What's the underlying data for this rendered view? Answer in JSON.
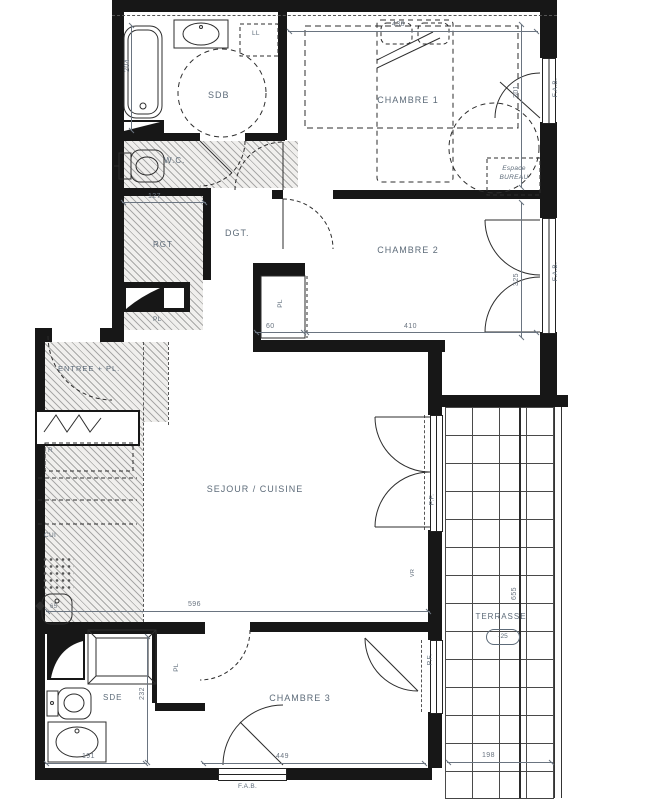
{
  "plan": {
    "rooms": {
      "sdb": "SDB",
      "chambre1": "CHAMBRE 1",
      "wc": "W.C.",
      "dgt": "DGT.",
      "chambre2": "CHAMBRE 2",
      "rgt": "RGT",
      "entree": "ENTREE + PL.",
      "sejour": "SEJOUR / CUISINE",
      "chambre3": "CHAMBRE 3",
      "sde": "SDE",
      "terrasse": "TERRASSE",
      "espace_bureau_1": "Espace",
      "espace_bureau_2": "BUREAU"
    },
    "closets": {
      "pl_couloir": "PL",
      "pl_chambre2": "PL",
      "pl_chambre3": "PL"
    },
    "appliances": {
      "lave_linge": "LL",
      "refrigerateur": "R",
      "cuisine": "CUI"
    },
    "windows": {
      "fab_chambre1": "F.A.B.",
      "fab_chambre2": "F.A.B.",
      "fab_chambre3": "F.A.B.",
      "pf_sejour": "P.F.",
      "pf_chambre3": "P.F.",
      "volet": "VR"
    },
    "levels": {
      "terrasse_level": "-25"
    },
    "dimensions": {
      "baignoire": "204",
      "chambre1_largeur": "438",
      "chambre1_hauteur": "301",
      "wc_largeur": "127",
      "placard_largeur": "60",
      "chambre2_largeur": "410",
      "chambre2_hauteur": "325",
      "sejour_largeur": "596",
      "evier": "65",
      "sde_largeur": "191",
      "sde_hauteur": "232",
      "chambre3_largeur": "449",
      "terrasse_largeur": "198",
      "terrasse_hauteur": "655"
    }
  }
}
